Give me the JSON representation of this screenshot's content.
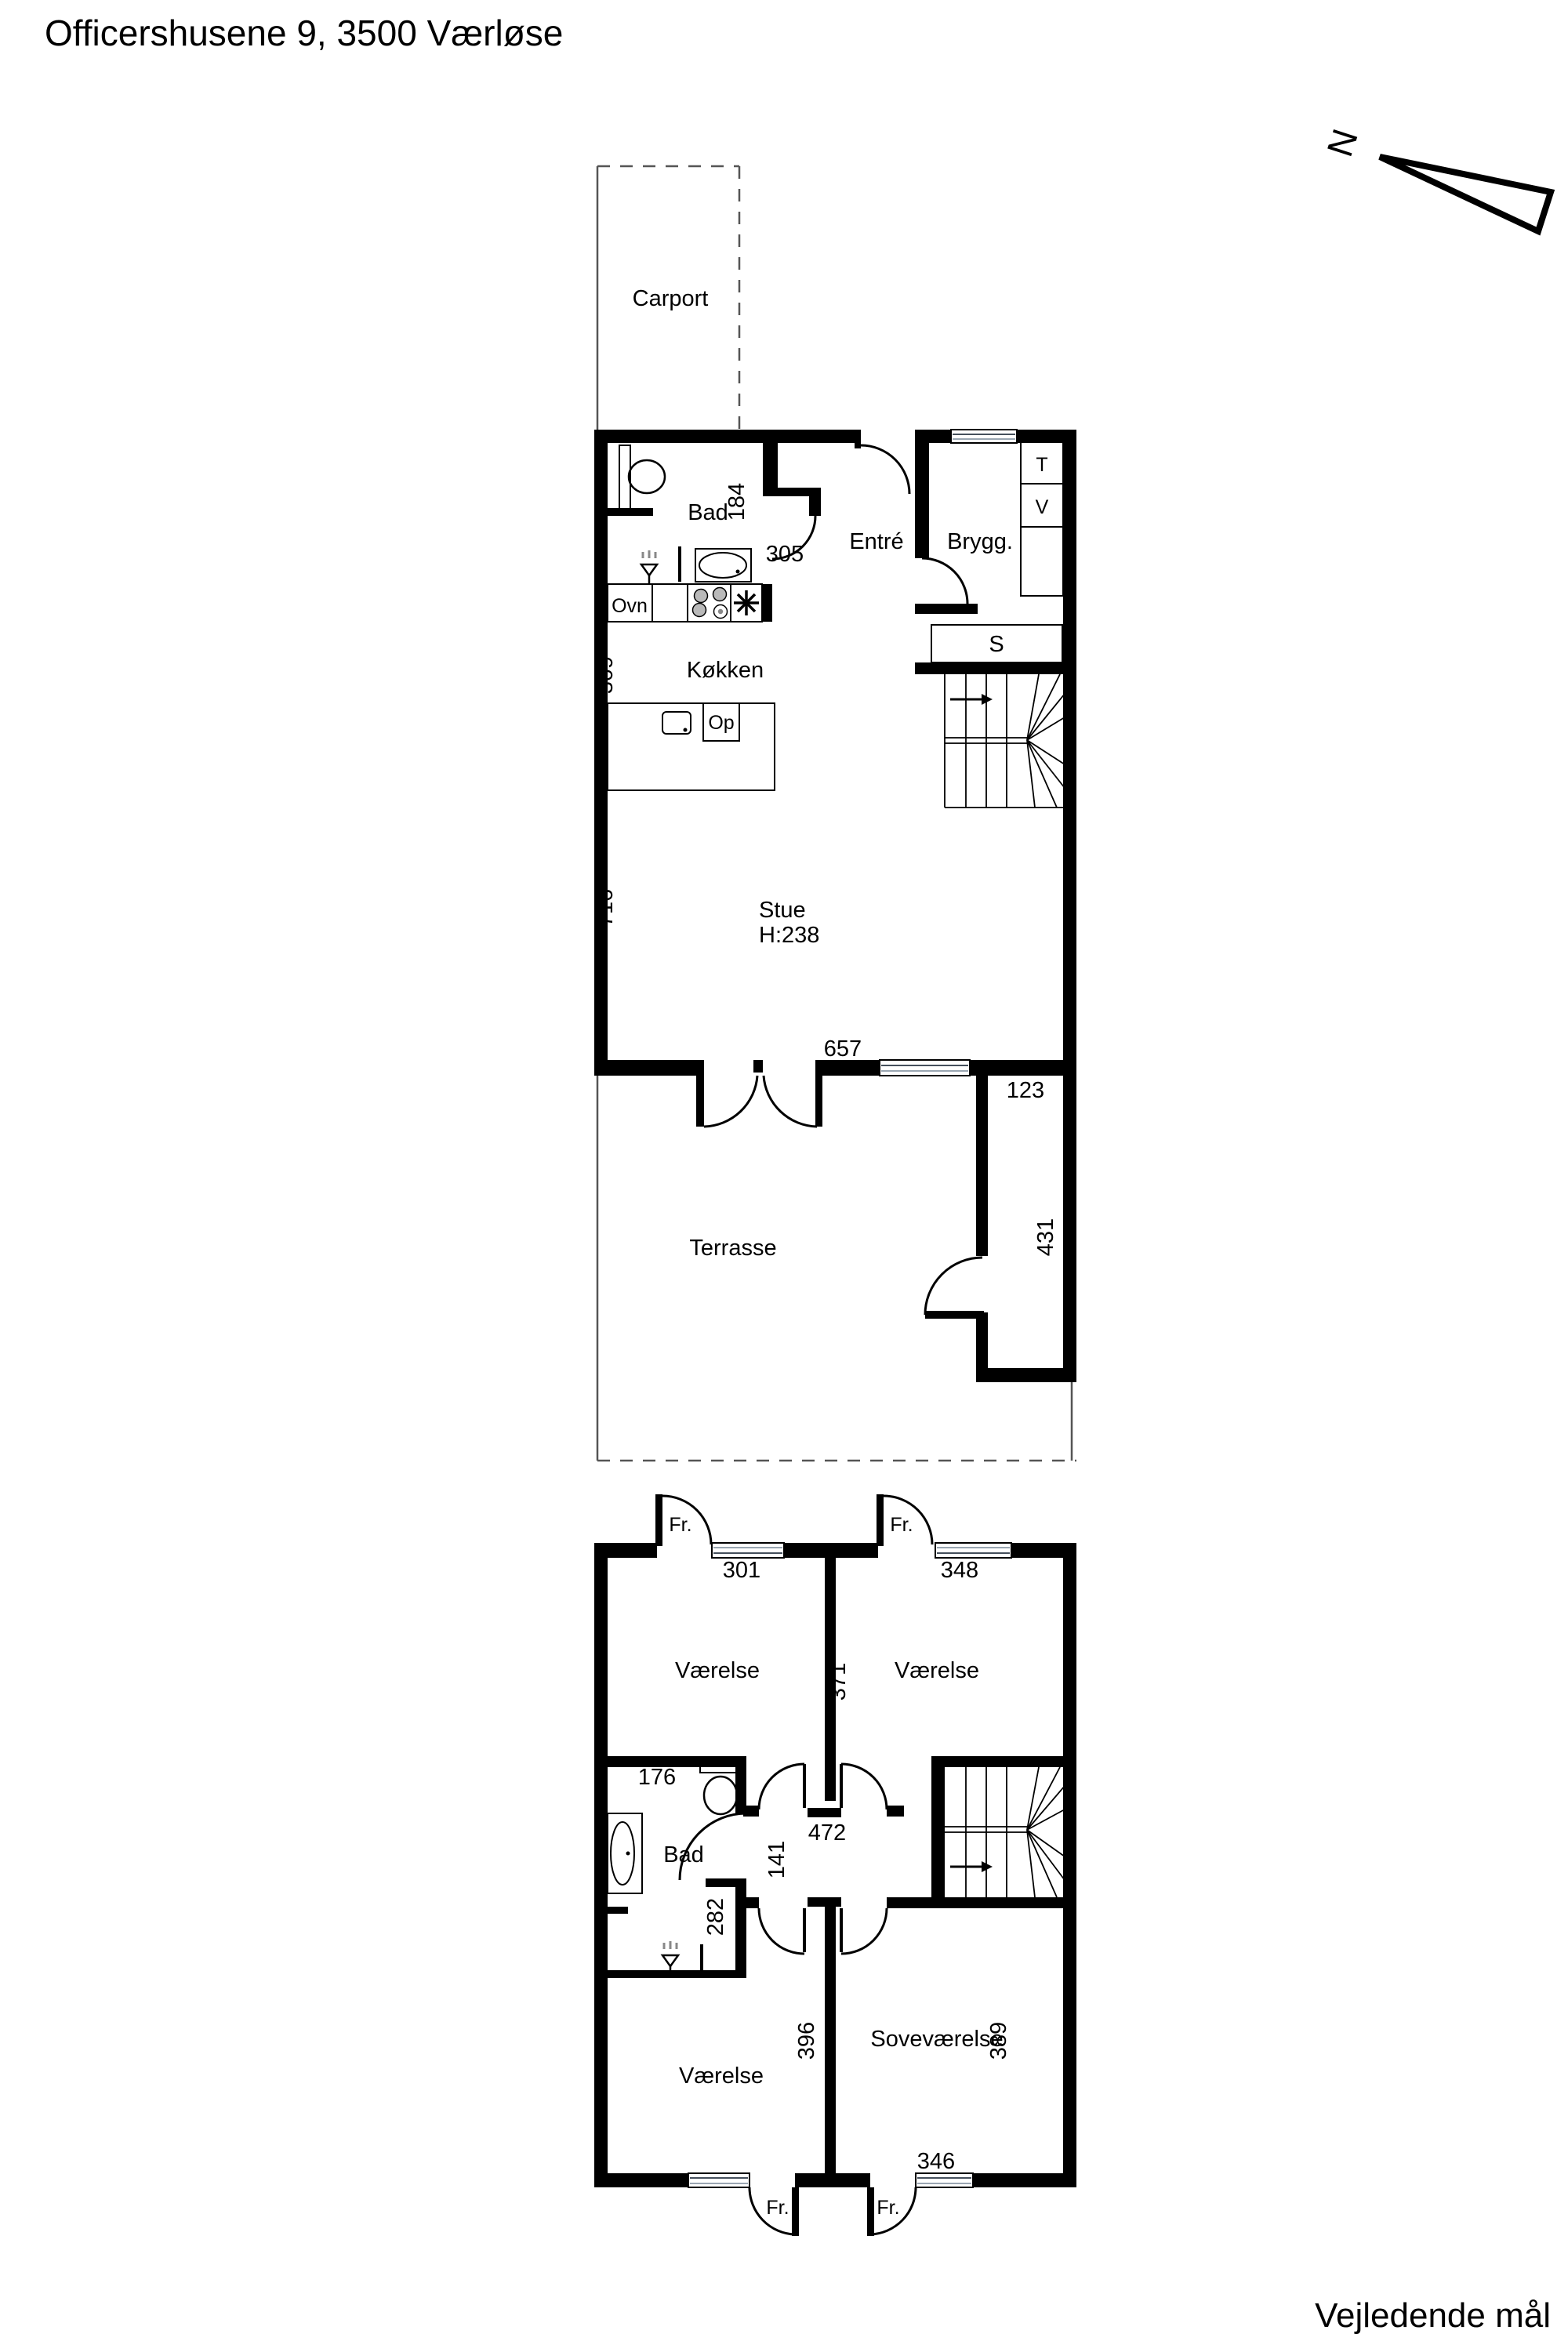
{
  "title": "Officershusene 9, 3500 Værløse",
  "footer_note": "Vejledende mål",
  "compass": {
    "north_label": "N"
  },
  "ground_floor": {
    "rooms": {
      "carport": "Carport",
      "bad": "Bad",
      "entre": "Entré",
      "bryggers": "Brygg.",
      "kokken": "Køkken",
      "stue": "Stue",
      "stue_ceiling": "H:238",
      "terrasse": "Terrasse"
    },
    "fixtures": {
      "oven": "Ovn",
      "dishwasher": "Op",
      "dryer": "T",
      "washer": "V",
      "closet": "S"
    },
    "dims": {
      "bad": "184",
      "kokken_door": "305",
      "kokken_wall": "309",
      "stue_wall": "716",
      "stue_width": "657",
      "annex_width": "123",
      "annex_depth": "431"
    }
  },
  "first_floor": {
    "rooms": {
      "room_nw": "Værelse",
      "room_ne": "Værelse",
      "room_sw": "Værelse",
      "bedroom": "Soveværelse",
      "bad": "Bad"
    },
    "door_labels": {
      "fr_nw": "Fr.",
      "fr_ne": "Fr.",
      "fr_sw": "Fr.",
      "fr_se": "Fr."
    },
    "dims": {
      "room_nw_width": "301",
      "room_ne_width": "348",
      "room_depth": "371",
      "bad_top": "176",
      "hall": "141",
      "hall_width": "472",
      "bad_depth": "282",
      "room_sw_depth": "396",
      "bedroom_depth": "389",
      "bedroom_width": "346"
    }
  }
}
